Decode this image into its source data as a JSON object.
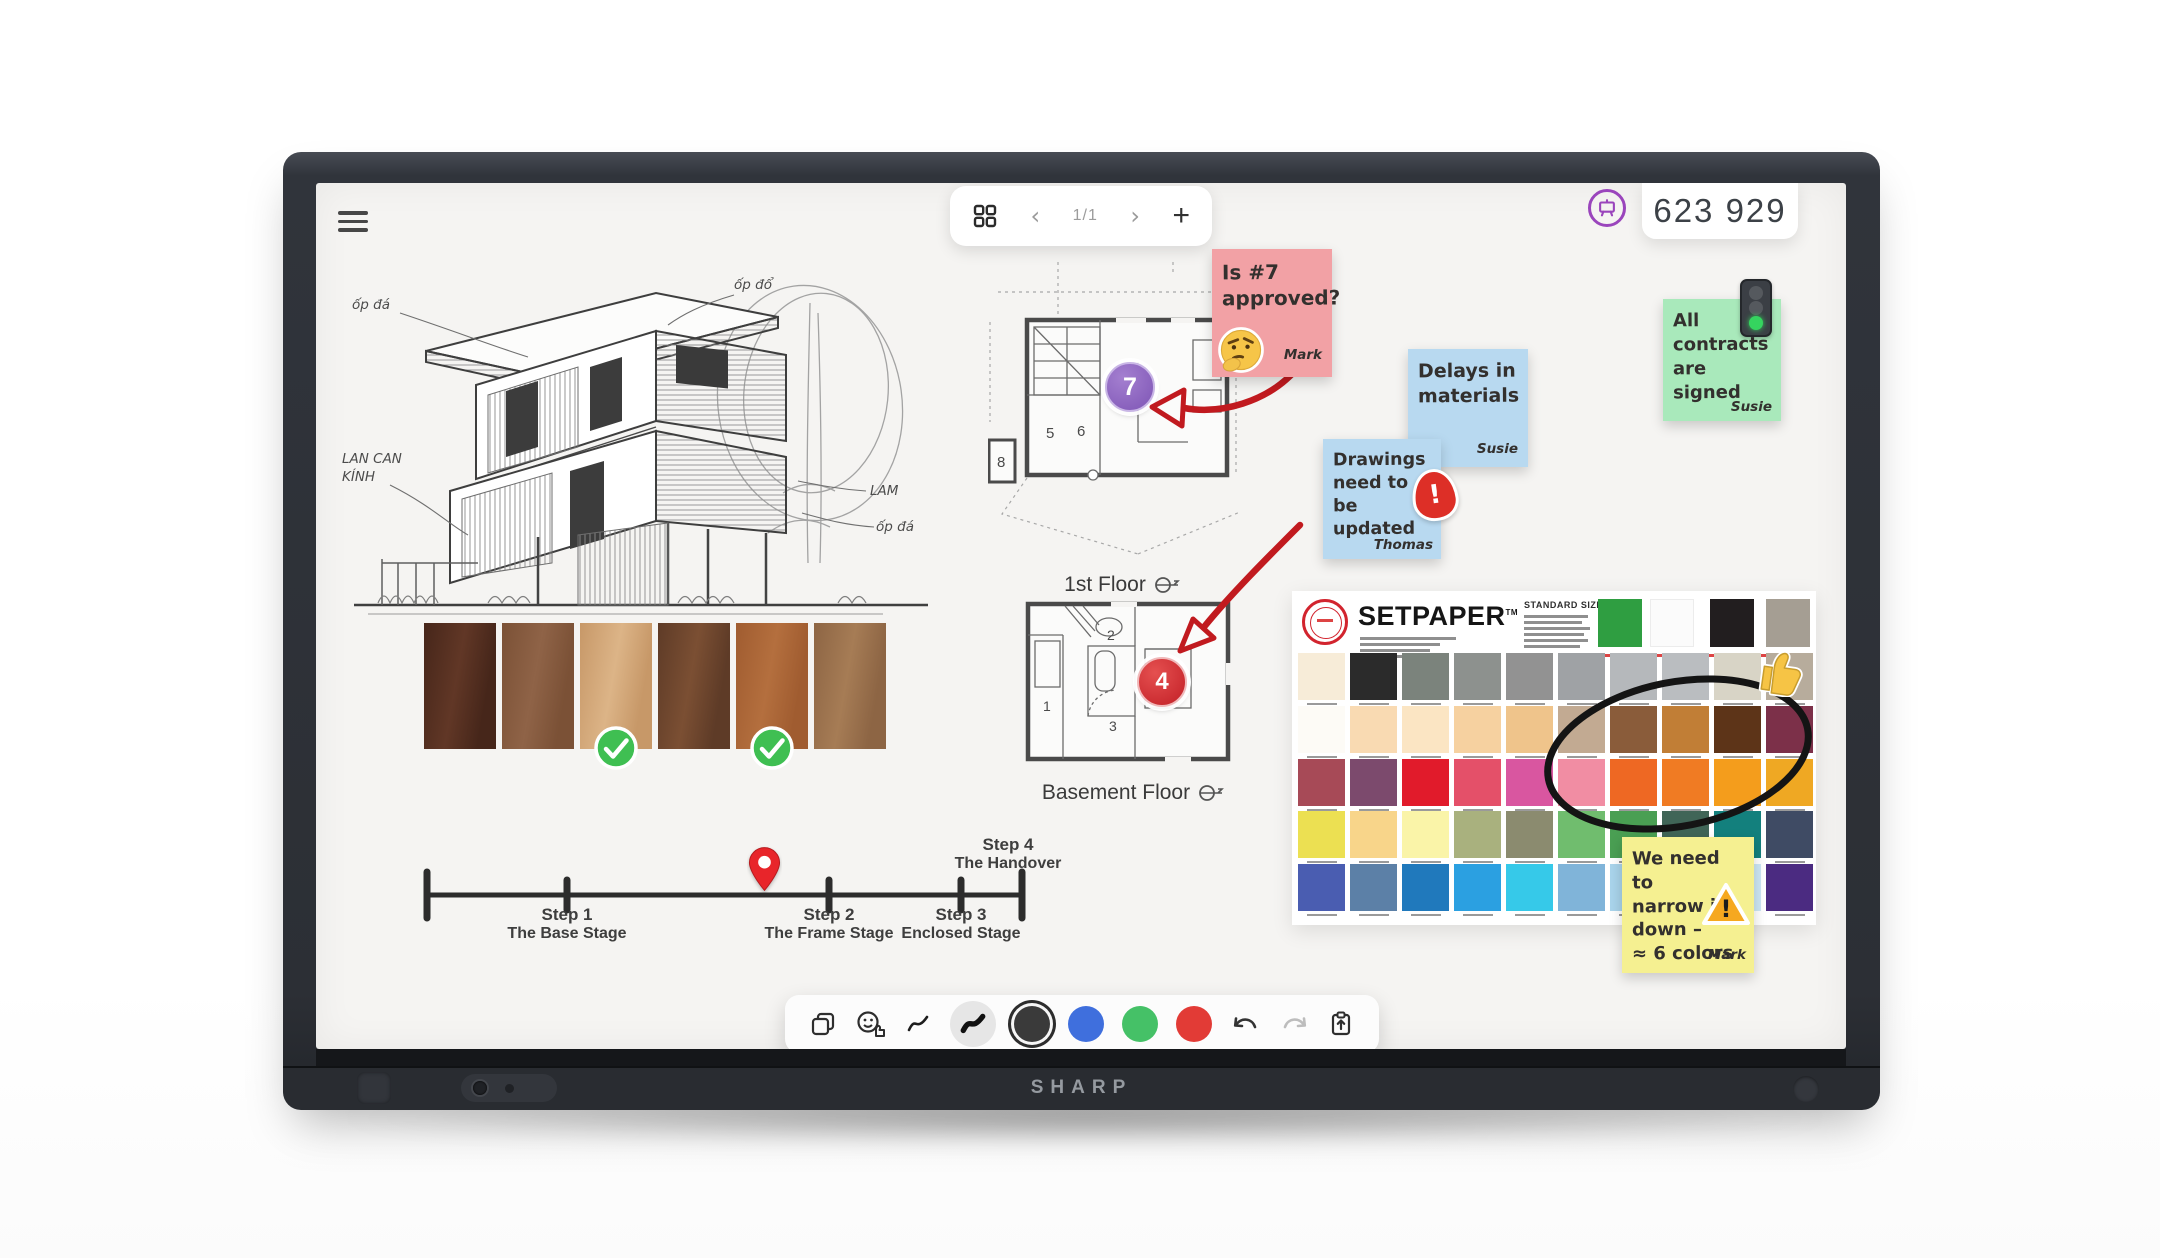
{
  "device": {
    "brand": "SHARP"
  },
  "top_bar": {
    "page_indicator": "1/1",
    "prev_label": "‹",
    "next_label": "›",
    "add_label": "+",
    "session_code": "623 929"
  },
  "colors": {
    "accent_purple": "#9a45bc",
    "annotation_red": "#c11a1f",
    "whiteboard_bg": "#f5f4f2"
  },
  "sketch": {
    "annotations": {
      "top_left": "ốp đá",
      "top_right": "ốp đổ",
      "mid_left_1": "LAN CAN",
      "mid_left_2": "KÍNH",
      "right_1": "LAM",
      "right_2": "ốp đá"
    }
  },
  "wood": {
    "swatches": [
      {
        "top": "#46261a",
        "bottom": "#613726",
        "checked": false
      },
      {
        "top": "#7b5136",
        "bottom": "#8f6347",
        "checked": false
      },
      {
        "top": "#c79868",
        "bottom": "#dcb487",
        "checked": true
      },
      {
        "top": "#5e3b27",
        "bottom": "#7b4f33",
        "checked": false
      },
      {
        "top": "#a05c30",
        "bottom": "#b46f3e",
        "checked": true
      },
      {
        "top": "#8d6544",
        "bottom": "#a67c55",
        "checked": false
      }
    ]
  },
  "timeline": {
    "steps": [
      {
        "title": "Step 1",
        "subtitle": "The Base Stage"
      },
      {
        "title": "Step 2",
        "subtitle": "The Frame Stage"
      },
      {
        "title": "Step 3",
        "subtitle": "Enclosed Stage"
      },
      {
        "title": "Step 4",
        "subtitle": "The Handover"
      }
    ]
  },
  "floor_plans": {
    "first": {
      "label": "1st Floor",
      "badge": "7",
      "badge_color": "#8a5fc0",
      "rooms": [
        "5",
        "6",
        "8"
      ]
    },
    "basement": {
      "label": "Basement Floor",
      "badge": "4",
      "badge_color": "#d6252b",
      "rooms": [
        "1",
        "2",
        "3"
      ]
    }
  },
  "notes": {
    "pink": {
      "color": "#f2a1a5",
      "lines": [
        "Is #7",
        "approved?"
      ],
      "author": "Mark",
      "icon": "thinking-emoji"
    },
    "blue1": {
      "color": "#b8d9f0",
      "lines": [
        "Delays in",
        "materials"
      ],
      "author": "Susie"
    },
    "blue2": {
      "color": "#b8d9f0",
      "lines": [
        "Drawings",
        "need to be",
        "updated"
      ],
      "author": "Thomas",
      "icon": "urgent-flame"
    },
    "green": {
      "color": "#a9e9bb",
      "lines": [
        "All",
        "contracts",
        "are signed"
      ],
      "author": "Susie",
      "icon": "traffic-light-green"
    },
    "yellow": {
      "color": "#f5f091",
      "lines": [
        "We need to",
        "narrow it",
        "down –",
        "≈ 6 colors"
      ],
      "author": "Mark",
      "icon": "warning-triangle"
    }
  },
  "setpaper": {
    "brand": "SETPAPER",
    "tm": "TM",
    "sizes_heading": "STANDARD SIZES",
    "top_swatches": [
      "#2f9e41",
      "#fbfbfb",
      "#221e1f",
      "#a59e93"
    ],
    "rows": [
      [
        "#f7ecd8",
        "#2b2b2b",
        "#7b837c",
        "#8d918e",
        "#929292",
        "#9fa2a5",
        "#b5b8bb",
        "#babdc0",
        "#d8d4c6",
        "#b7ac9c"
      ],
      [
        "#fdfbf6",
        "#f9dab2",
        "#fbe5c3",
        "#f6d1a0",
        "#efc48b",
        "#c2aa92",
        "#8a5c3a",
        "#c17e36",
        "#5d3418",
        "#7c3049"
      ],
      [
        "#a74a57",
        "#7c4a6d",
        "#e11b2b",
        "#e45069",
        "#d956a0",
        "#f18da3",
        "#ee6823",
        "#f07b23",
        "#f49d1c",
        "#efa823"
      ],
      [
        "#ece052",
        "#f8d58a",
        "#faf4a8",
        "#a9b17e",
        "#8b8b6f",
        "#70bd6e",
        "#4a9f53",
        "#406557",
        "#13807d",
        "#3f4b64"
      ],
      [
        "#4a5db1",
        "#5c80a7",
        "#2079bc",
        "#2ba0e1",
        "#36c9e9",
        "#80b4d9",
        "#a9d4eb",
        "#b9ddf0",
        "#cde7f5",
        "#4b2b81"
      ]
    ]
  },
  "toolbar": {
    "tools": [
      {
        "name": "duplicate"
      },
      {
        "name": "sticker"
      },
      {
        "name": "pen-thin"
      },
      {
        "name": "pen-thick",
        "selected": true
      },
      {
        "name": "color-black",
        "color": "#3a3a3a",
        "selected": true
      },
      {
        "name": "color-blue",
        "color": "#3f6fdd"
      },
      {
        "name": "color-green",
        "color": "#45c167"
      },
      {
        "name": "color-red",
        "color": "#e23b36"
      }
    ]
  },
  "icons": {
    "menu": "hamburger-icon",
    "pages": "grid-icon",
    "share": "whiteboard-share-icon",
    "undo": "undo-icon",
    "redo": "redo-icon",
    "paste": "clipboard-icon",
    "approved": "thumbs-up-sticker",
    "pin": "location-pin-icon",
    "orientation": "north-orientation-icon"
  }
}
